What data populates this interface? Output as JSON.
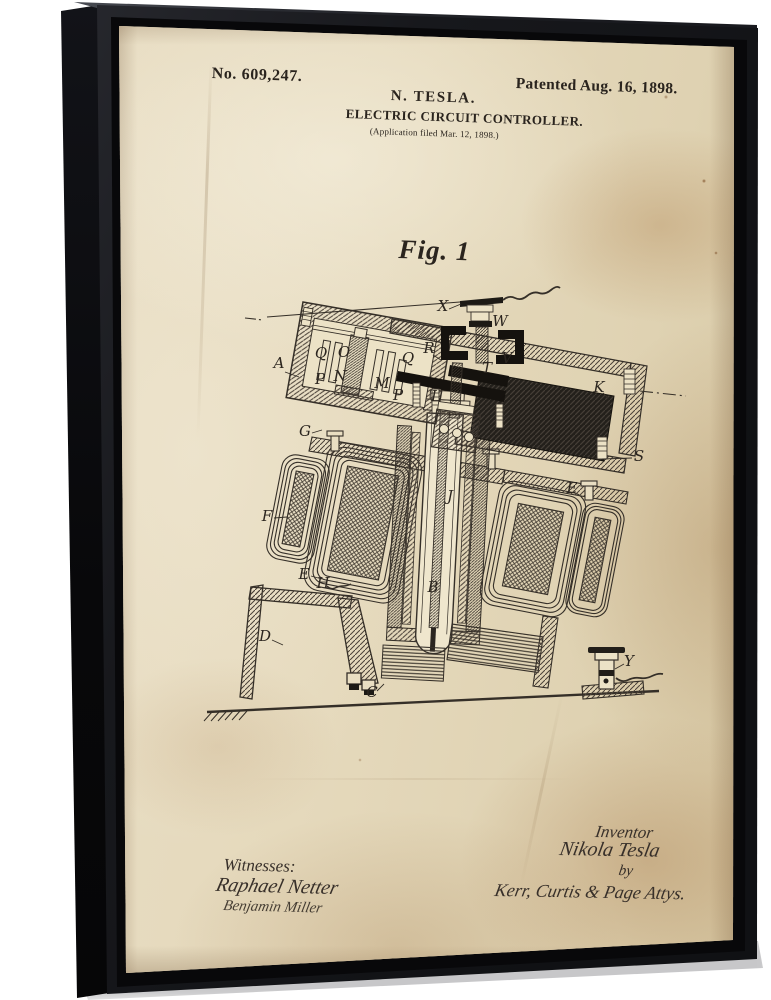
{
  "artwork": {
    "header": {
      "patent_number": "No. 609,247.",
      "patent_date": "Patented Aug. 16, 1898.",
      "inventor_name": "N. TESLA.",
      "title": "ELECTRIC CIRCUIT CONTROLLER.",
      "application_line": "(Application filed Mar. 12, 1898.)"
    },
    "figure_label": "Fig. 1",
    "drawing": {
      "labels": [
        "A",
        "X",
        "W",
        "R",
        "T",
        "V",
        "L",
        "Q",
        "O",
        "Q",
        "P",
        "N",
        "M",
        "P",
        "G",
        "K",
        "S",
        "E",
        "F",
        "E",
        "H",
        "B",
        "J",
        "D",
        "C",
        "Y"
      ]
    },
    "footer": {
      "witnesses_heading": "Witnesses:",
      "witness_signature_1": "Raphael Netter",
      "witness_signature_2": "Benjamin Miller",
      "inventor_heading": "Inventor",
      "inventor_signature": "Nikola Tesla",
      "by_label": "by",
      "attorney_signature": "Kerr, Curtis & Page Attys."
    },
    "colors": {
      "frame": "#17181c",
      "frame_side": "#0a0a0c",
      "parchment": "#e2d5b6",
      "ink": "#2a241e",
      "background": "#ffffff"
    }
  }
}
